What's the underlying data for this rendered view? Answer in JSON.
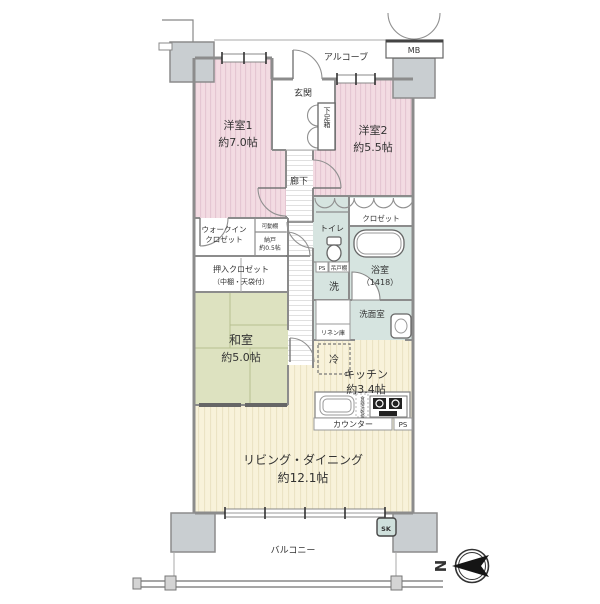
{
  "title": "マンション間取り図",
  "compass": {
    "north": "N"
  },
  "exterior": {
    "alcove": "アルコーブ",
    "mb": "MB",
    "balcony": "バルコニー",
    "sk": "SK"
  },
  "entrance": {
    "name": "玄関",
    "shoebox": "下足箱",
    "corridor": "廊下"
  },
  "bedroom1": {
    "name": "洋室1",
    "size": "約7.0帖"
  },
  "bedroom2": {
    "name": "洋室2",
    "size": "約5.5帖",
    "closet": "クロゼット"
  },
  "japanese_room": {
    "name": "和室",
    "size": "約5.0帖"
  },
  "storage": {
    "wic_line1": "ウォークイン",
    "wic_line2": "クロゼット",
    "shelf": "可動棚",
    "nando_name": "納戸",
    "nando_size": "約0.5帖",
    "oshiire_line1": "押入クロゼット",
    "oshiire_line2": "（中棚・天袋付）",
    "linen": "リネン庫"
  },
  "sanitary": {
    "toilet": "トイレ",
    "bath_name": "浴室",
    "bath_size": "（1418）",
    "washroom": "洗面室",
    "laundry": "洗",
    "ps": "PS",
    "cupboard": "吊戸棚"
  },
  "kitchen": {
    "name": "キッチン",
    "size": "約3.4帖",
    "fridge": "冷",
    "counter": "カウンター",
    "ps": "PS",
    "dishwasher": "食器洗乾燥機"
  },
  "living": {
    "name": "リビング・ダイニング",
    "size": "約12.1帖"
  },
  "colors": {
    "pink": "#f3dbe2",
    "pink_stripe": "#e5c6d2",
    "cream": "#f8f2da",
    "cream_stripe": "#ebe3c4",
    "tatami": "#dde2c0",
    "teal": "#d6e4e0",
    "pillar": "#c9ced1",
    "wall": "#8c8c8c"
  }
}
